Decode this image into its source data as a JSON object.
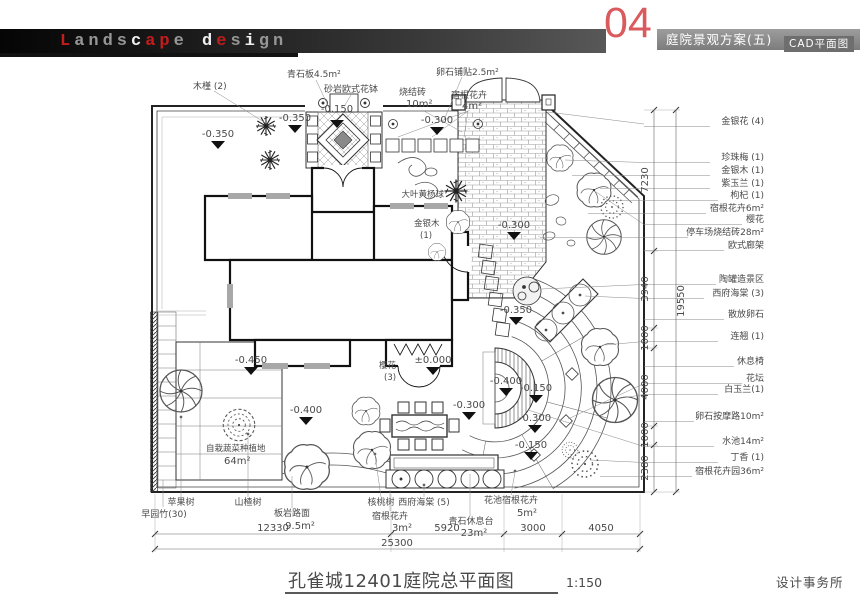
{
  "colors": {
    "accent": "#d95b5e",
    "logo_red": "#c21d1d",
    "bar_gray": "#8d8d8d",
    "footer_red": "#e23a3a",
    "line": "#333333"
  },
  "header": {
    "logo": [
      {
        "t": "L"
      },
      {
        "t": "ands"
      },
      {
        "t": "c"
      },
      {
        "t": "ap"
      },
      {
        "t": "e"
      },
      {
        "t": " d"
      },
      {
        "t": "e"
      },
      {
        "t": "s"
      },
      {
        "t": "i"
      },
      {
        "t": "gn"
      }
    ],
    "number": "04",
    "scheme_title": "庭院景观方案(五)",
    "sub_title": "CAD平面图"
  },
  "plan": {
    "top_labels": [
      "木槿 (2)",
      "青石板4.5m²",
      "砂岩欧式花钵",
      "烧结砖",
      "10m²",
      "卵石铺贴2.5m²",
      "宿根花卉",
      "4m²"
    ],
    "inplan_labels": [
      "大叶黄杨球",
      "金银木",
      "(1)",
      "樱花",
      "(3)",
      "自栽蔬菜种植地",
      "64m²"
    ],
    "elevations": [
      "-0.350",
      "-0.350",
      "-0.150",
      "-0.300",
      "-0.300",
      "-0.350",
      "-0.450",
      "-0.400",
      "±0.000",
      "-0.300",
      "-0.400",
      "-0.150",
      "-0.300",
      "-0.150"
    ],
    "right_labels": [
      "金银花 (4)",
      "珍珠梅 (1)",
      "金银木 (1)",
      "紫玉兰 (1)",
      "枸杞 (1)",
      "宿根花卉6m²",
      "樱花",
      "停车场烧结砖28m²",
      "欧式廊架",
      "陶罐造景区",
      "西府海棠 (3)",
      "散放卵石",
      "连翘 (1)",
      "休息椅",
      "花坛",
      "白玉兰(1)",
      "卵石按摩路10m²",
      "水池14m²",
      "丁香 (1)",
      "宿根花卉园36m²"
    ],
    "bottom_labels": [
      "苹果树",
      "早园竹(30)",
      "山楂树",
      "板岩路面",
      "9.5m²",
      "核桃树",
      "宿根花卉",
      "3m²",
      "西府海棠 (5)",
      "青石休息台",
      "23m²",
      "花池宿根花卉",
      "5m²"
    ],
    "dims_right": [
      "7230",
      "3940",
      "1000",
      "4000",
      "1000",
      "2380"
    ],
    "dims_right_total": "19550",
    "dims_bottom": [
      "12330",
      "5920",
      "3000",
      "4050"
    ],
    "dims_bottom_total": "25300"
  },
  "title": {
    "name": "孔雀城12401庭院总平面图",
    "scale": "1:150"
  },
  "footer": {
    "studio": "设计事务所"
  }
}
